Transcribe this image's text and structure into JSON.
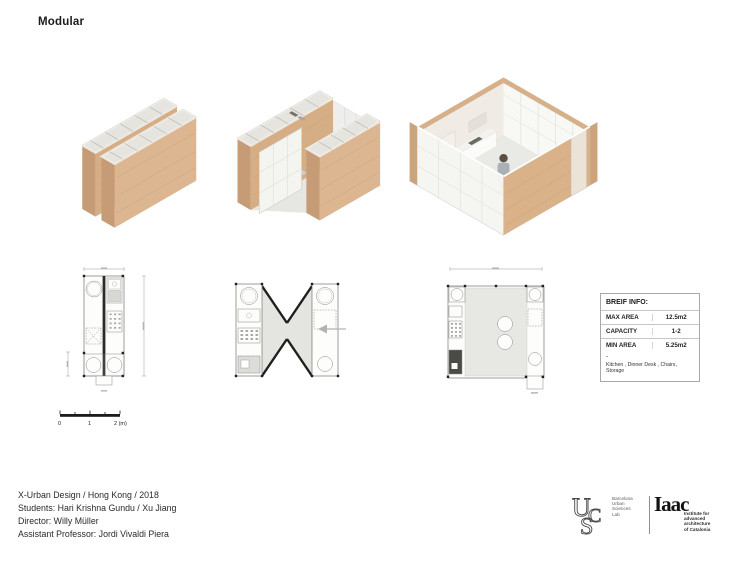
{
  "page": {
    "title": "Modular"
  },
  "brief_info": {
    "title": "BREIF INFO:",
    "rows": [
      {
        "label": "MAX AREA",
        "value": "12.5m2"
      },
      {
        "label": "CAPACITY",
        "value": "1-2"
      },
      {
        "label": "MIN AREA",
        "value": "5.25m2"
      }
    ],
    "note_dash": "-",
    "note": "Kitchen , Dinner Desk , Chairs, Storage"
  },
  "scale_bar": {
    "labels": [
      "0",
      "1",
      "2 (m)"
    ]
  },
  "credits": {
    "lines": [
      "X-Urban Design / Hong Kong / 2018",
      "Students: Hari Krishna Gundu / Xu Jiang",
      "Director: Willy Müller",
      "Assistant Professor: Jordi Vivaldi Piera"
    ]
  },
  "logos": {
    "ucs": {
      "letters": [
        "U",
        "C",
        "S"
      ],
      "text_lines": [
        "Barcelona",
        "Urban",
        "Sciences",
        "Lab"
      ]
    },
    "iaac": {
      "wordmark": "Iaac",
      "text_lines": [
        "Institute for",
        "advanced",
        "architecture",
        "of Catalonia"
      ]
    }
  },
  "colors": {
    "wood_light": "#dcb690",
    "wood_mid": "#d6ae86",
    "wood_dark": "#c69c77",
    "panel_white": "#f4f4f1",
    "floor_gray": "#e7e7e4",
    "ink": "#1d1d1b"
  }
}
